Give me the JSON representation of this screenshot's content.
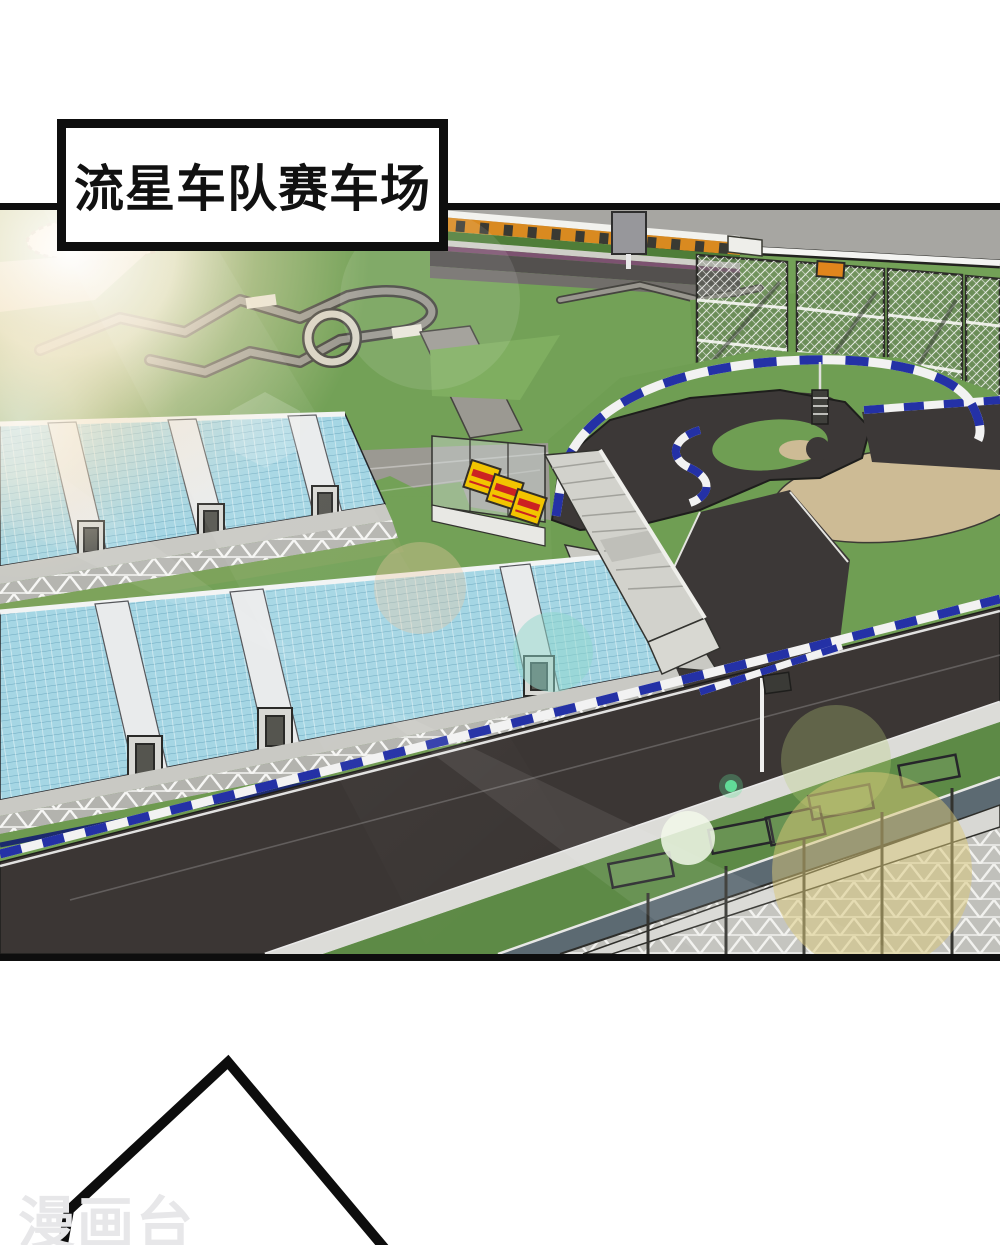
{
  "page": {
    "width": 1000,
    "height": 1245,
    "background": "#ffffff"
  },
  "caption": {
    "text": "流星车队赛车场"
  },
  "watermark": {
    "text": "漫画台"
  },
  "scene": {
    "description": "Aerial 3D rendering of the Meteor Team racing circuit: light-blue grandstands, dark asphalt pit straight with blue-and-white striped walls, snail-shaped hairpin with tan sand runoff, kart track and paddock roads, mesh fence enclosures, scaffold trusses, and strong lens-flare sunlight from the top-left. A speech-bubble tail outline sits in the white area below the panel.",
    "palette": {
      "grass": "#6f9e53",
      "grass_dark": "#58813f",
      "track_asphalt": "#3c3837",
      "sand": "#cdbb95",
      "seat_blue": "#a5d6e4",
      "curb_blue": "#2431a6",
      "curb_white": "#f2f2f2",
      "sky_gray": "#a7a6a2",
      "paddock_gray": "#9b9992",
      "concrete": "#cfcfc9",
      "banner_yellow": "#f2c400",
      "banner_red": "#cc2222",
      "stand_orange": "#d98a20",
      "purple_rail": "#7c5270",
      "border_black": "#0e0e0e"
    }
  }
}
